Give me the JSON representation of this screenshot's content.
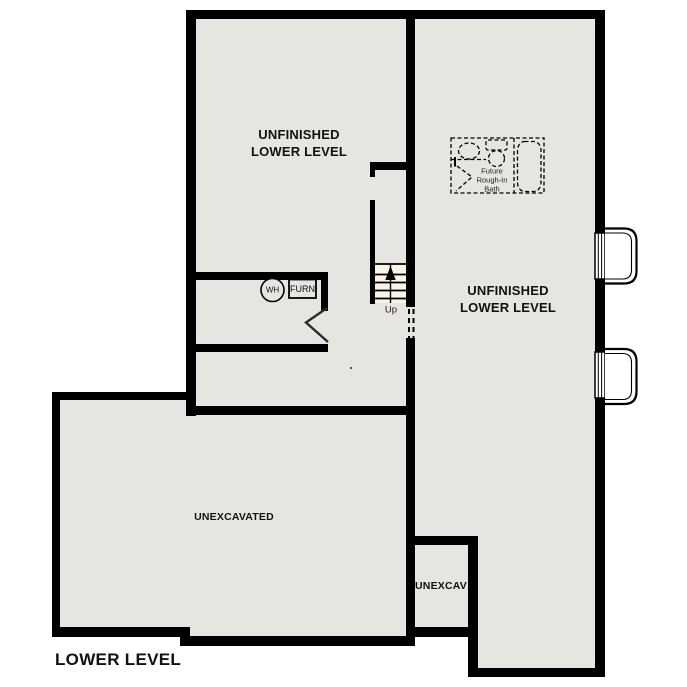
{
  "title": {
    "text": "LOWER LEVEL"
  },
  "rooms": {
    "left_room": {
      "line1": "UNFINISHED",
      "line2": "LOWER LEVEL"
    },
    "right_room": {
      "line1": "UNFINISHED",
      "line2": "LOWER LEVEL"
    },
    "unexcavated_large": {
      "label": "UNEXCAVATED"
    },
    "unexcavated_small": {
      "label": "UNEXCAV"
    }
  },
  "stairs": {
    "direction_label": "Up"
  },
  "utilities": {
    "water_heater": "WH",
    "furnace": "FURN"
  },
  "future_bath": {
    "line1": "Future",
    "line2": "Rough-In",
    "line3": "Bath"
  },
  "icons": {
    "up_arrow": "up-arrow-icon",
    "door_swing": "door-swing-icon",
    "sink": "sink-icon",
    "toilet": "toilet-icon",
    "tub": "tub-icon",
    "window_wells": "window-well-icon"
  },
  "colors": {
    "wall": "#000000",
    "floor": "#e6e5e2",
    "stair_fill": "#faf4e6",
    "background": "#ffffff",
    "text": "#111111"
  }
}
